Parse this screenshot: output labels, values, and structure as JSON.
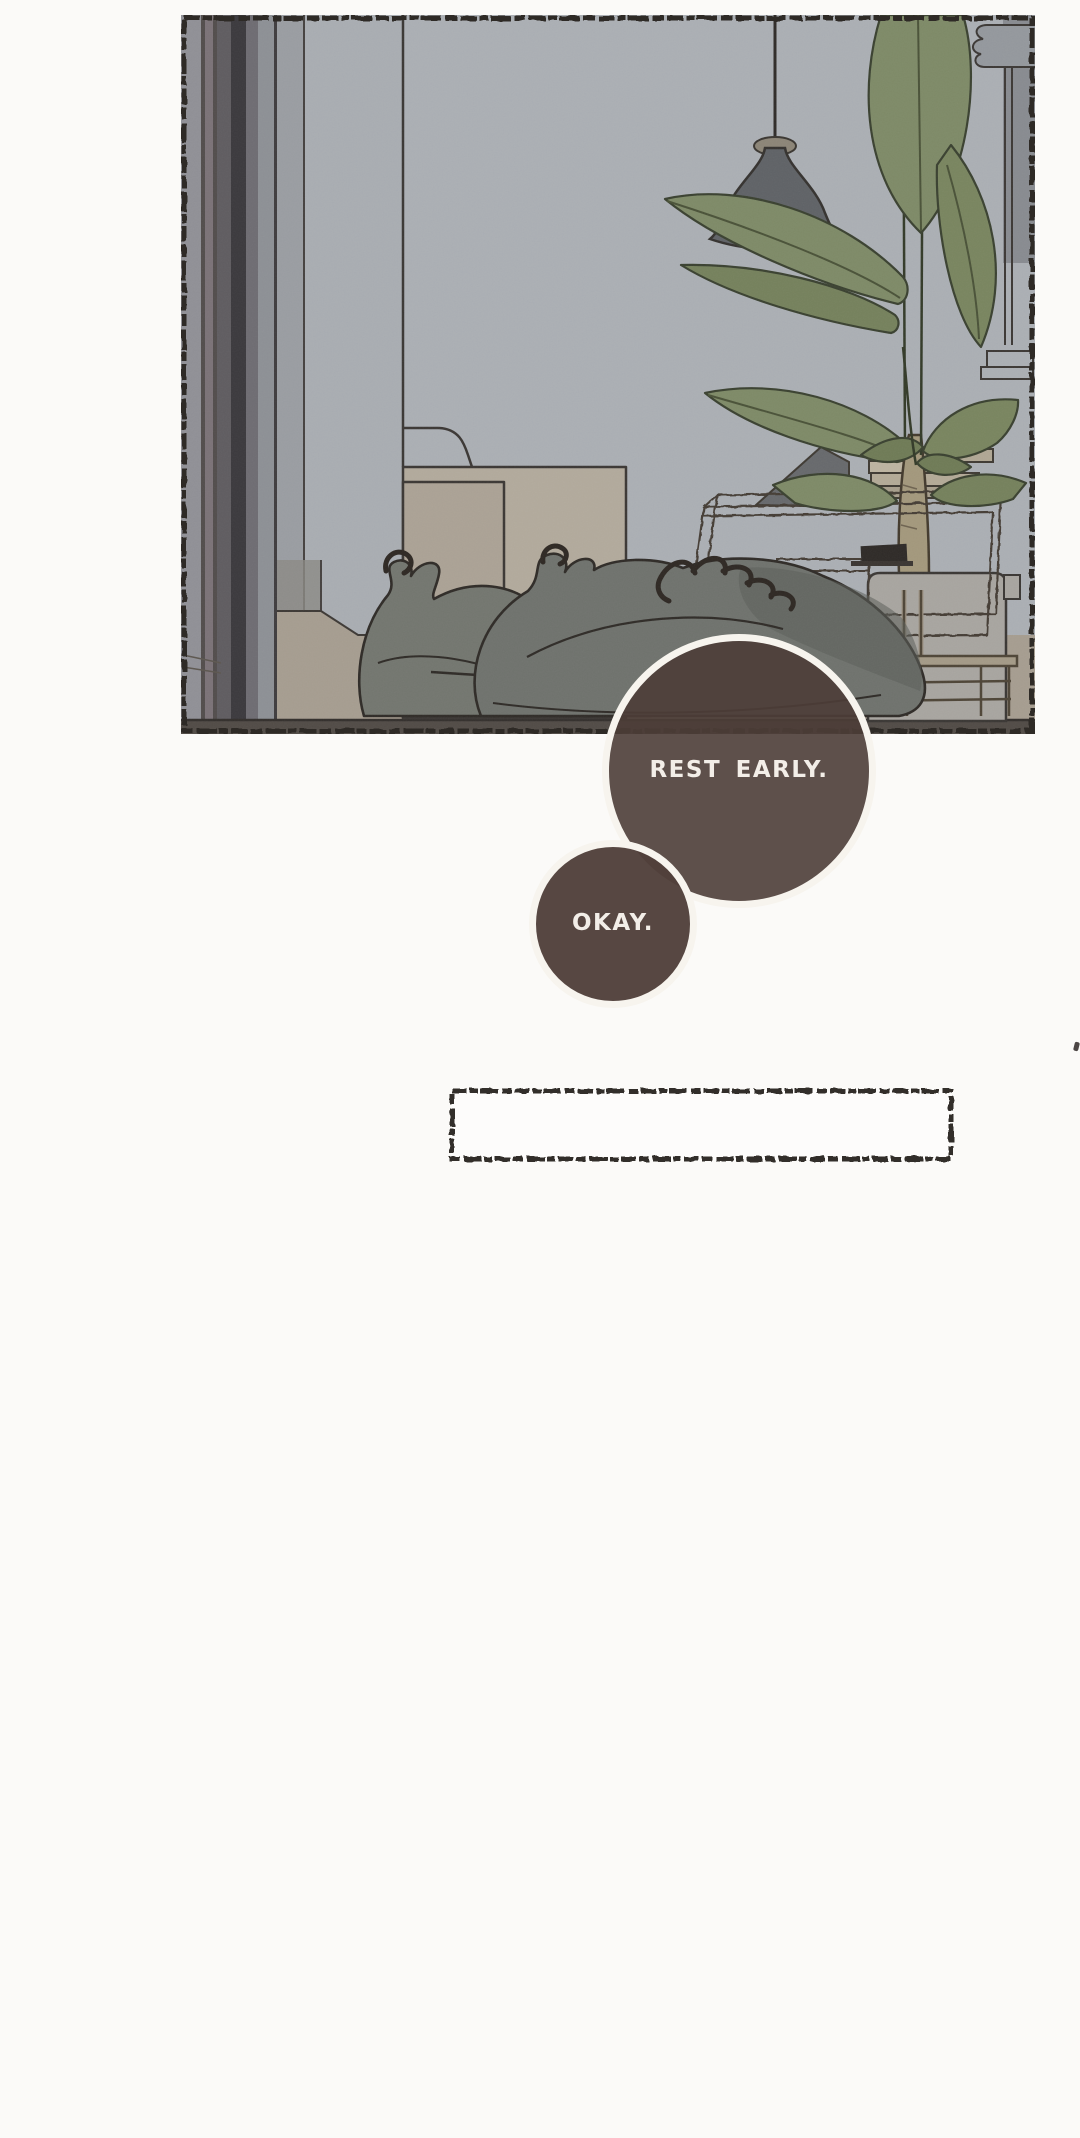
{
  "page": {
    "background_color": "#fbfaf8",
    "kind": "webtoon-episode-strip"
  },
  "panel": {
    "border_color": "#2d2927",
    "wall_color": "#a9adb2",
    "floor_color": "#a69d90",
    "plant_leaf_color": "#7e8a67",
    "lamp_color": "#5f6266",
    "sneaker_color": "#6f726d",
    "box_color": "#b2aa9c",
    "planter_color": "#a8a5a0"
  },
  "bubbles": [
    {
      "label": "REST EARLY.",
      "fill_color": "#5e4f4b",
      "ring_color": "#f7f4ee",
      "text_color": "#f3eee8"
    },
    {
      "label": "OKAY.",
      "fill_color": "#5e4f4b",
      "ring_color": "#f7f4ee",
      "text_color": "#f3eee8"
    }
  ],
  "caption_box": {
    "text": "",
    "border_color": "#332e2b",
    "fill_color": "#fdfcfb"
  }
}
